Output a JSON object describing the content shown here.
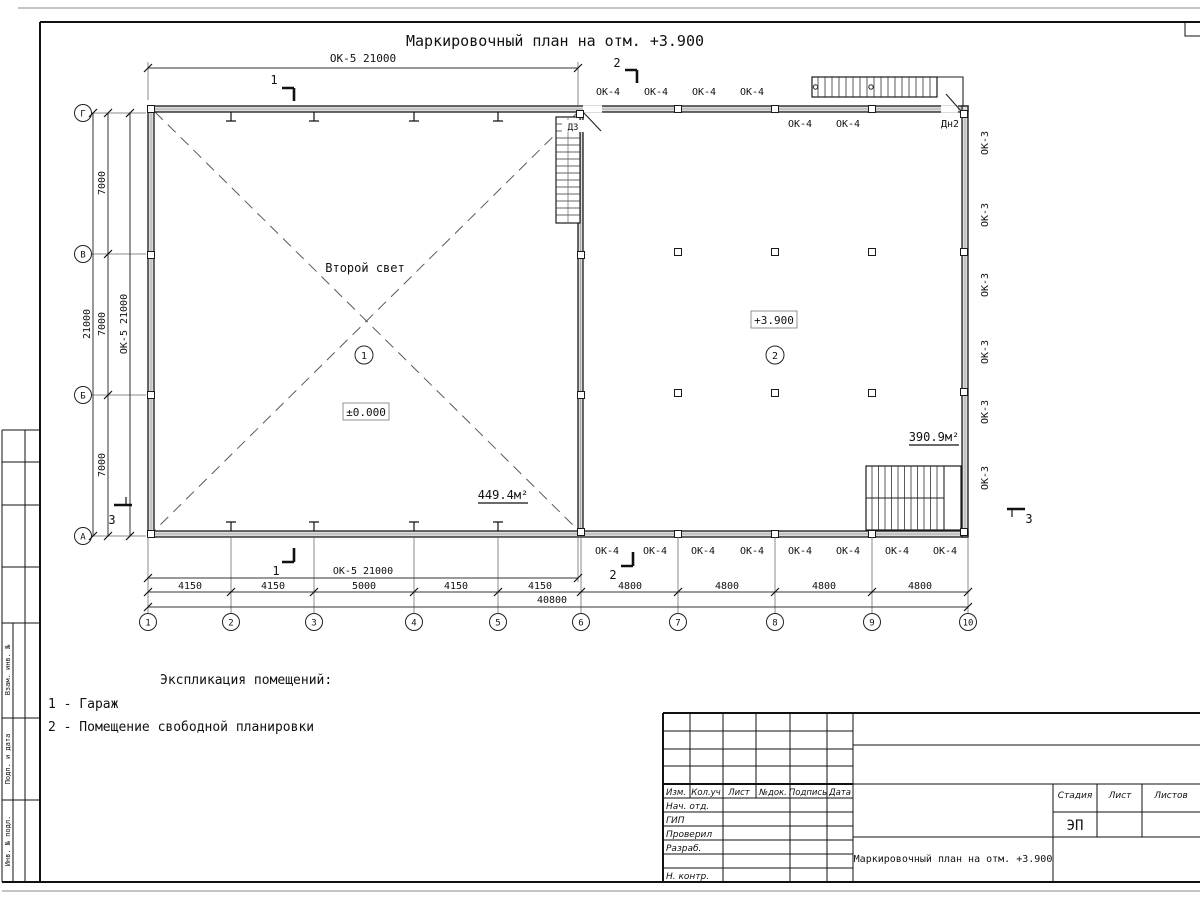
{
  "title": "Маркировочный план на отм. +3.900",
  "axes": {
    "cols": [
      "1",
      "2",
      "3",
      "4",
      "5",
      "6",
      "7",
      "8",
      "9",
      "10"
    ],
    "rows": [
      "Г",
      "В",
      "Б",
      "А"
    ]
  },
  "dims": {
    "ok5_21000": "ОК-5 21000",
    "bay_7000": "7000",
    "total_21000": "21000",
    "bays_bottom": [
      "4150",
      "4150",
      "5000",
      "4150",
      "4150",
      "4800",
      "4800",
      "4800",
      "4800"
    ],
    "total_40800": "40800"
  },
  "marks": {
    "s1": "1",
    "s2": "2",
    "s3": "3",
    "ok4": "ОК-4",
    "ok3": "ОК-3",
    "d3": "Д3",
    "dn2": "Дн2"
  },
  "rooms": {
    "r1": {
      "num": "1",
      "note": "Второй свет",
      "level": "±0.000",
      "area": "449.4м²"
    },
    "r2": {
      "num": "2",
      "level": "+3.900",
      "area": "390.9м²"
    }
  },
  "legend": {
    "heading": "Экспликация помещений:",
    "item1": "1 - Гараж",
    "item2": "2 - Помещение свободной планировки"
  },
  "titleblock": {
    "col_izm": "Изм.",
    "col_koluch": "Кол.уч",
    "col_list": "Лист",
    "col_ndok": "№док.",
    "col_podpis": "Подпись",
    "col_data": "Дата",
    "row_nachotd": "Нач. отд.",
    "row_gip": "ГИП",
    "row_proveril": "Проверил",
    "row_razrab": "Разраб.",
    "row_nkontr": "Н. контр.",
    "stage_label": "Стадия",
    "list_label": "Лист",
    "listov_label": "Листов",
    "stage_value": "ЭП",
    "doc_title": "Маркировочный план на отм. +3.900"
  },
  "frame": {
    "label1": "Взам. инв. №",
    "label2": "Подп. и дата",
    "label3": "Инв. № подл."
  }
}
